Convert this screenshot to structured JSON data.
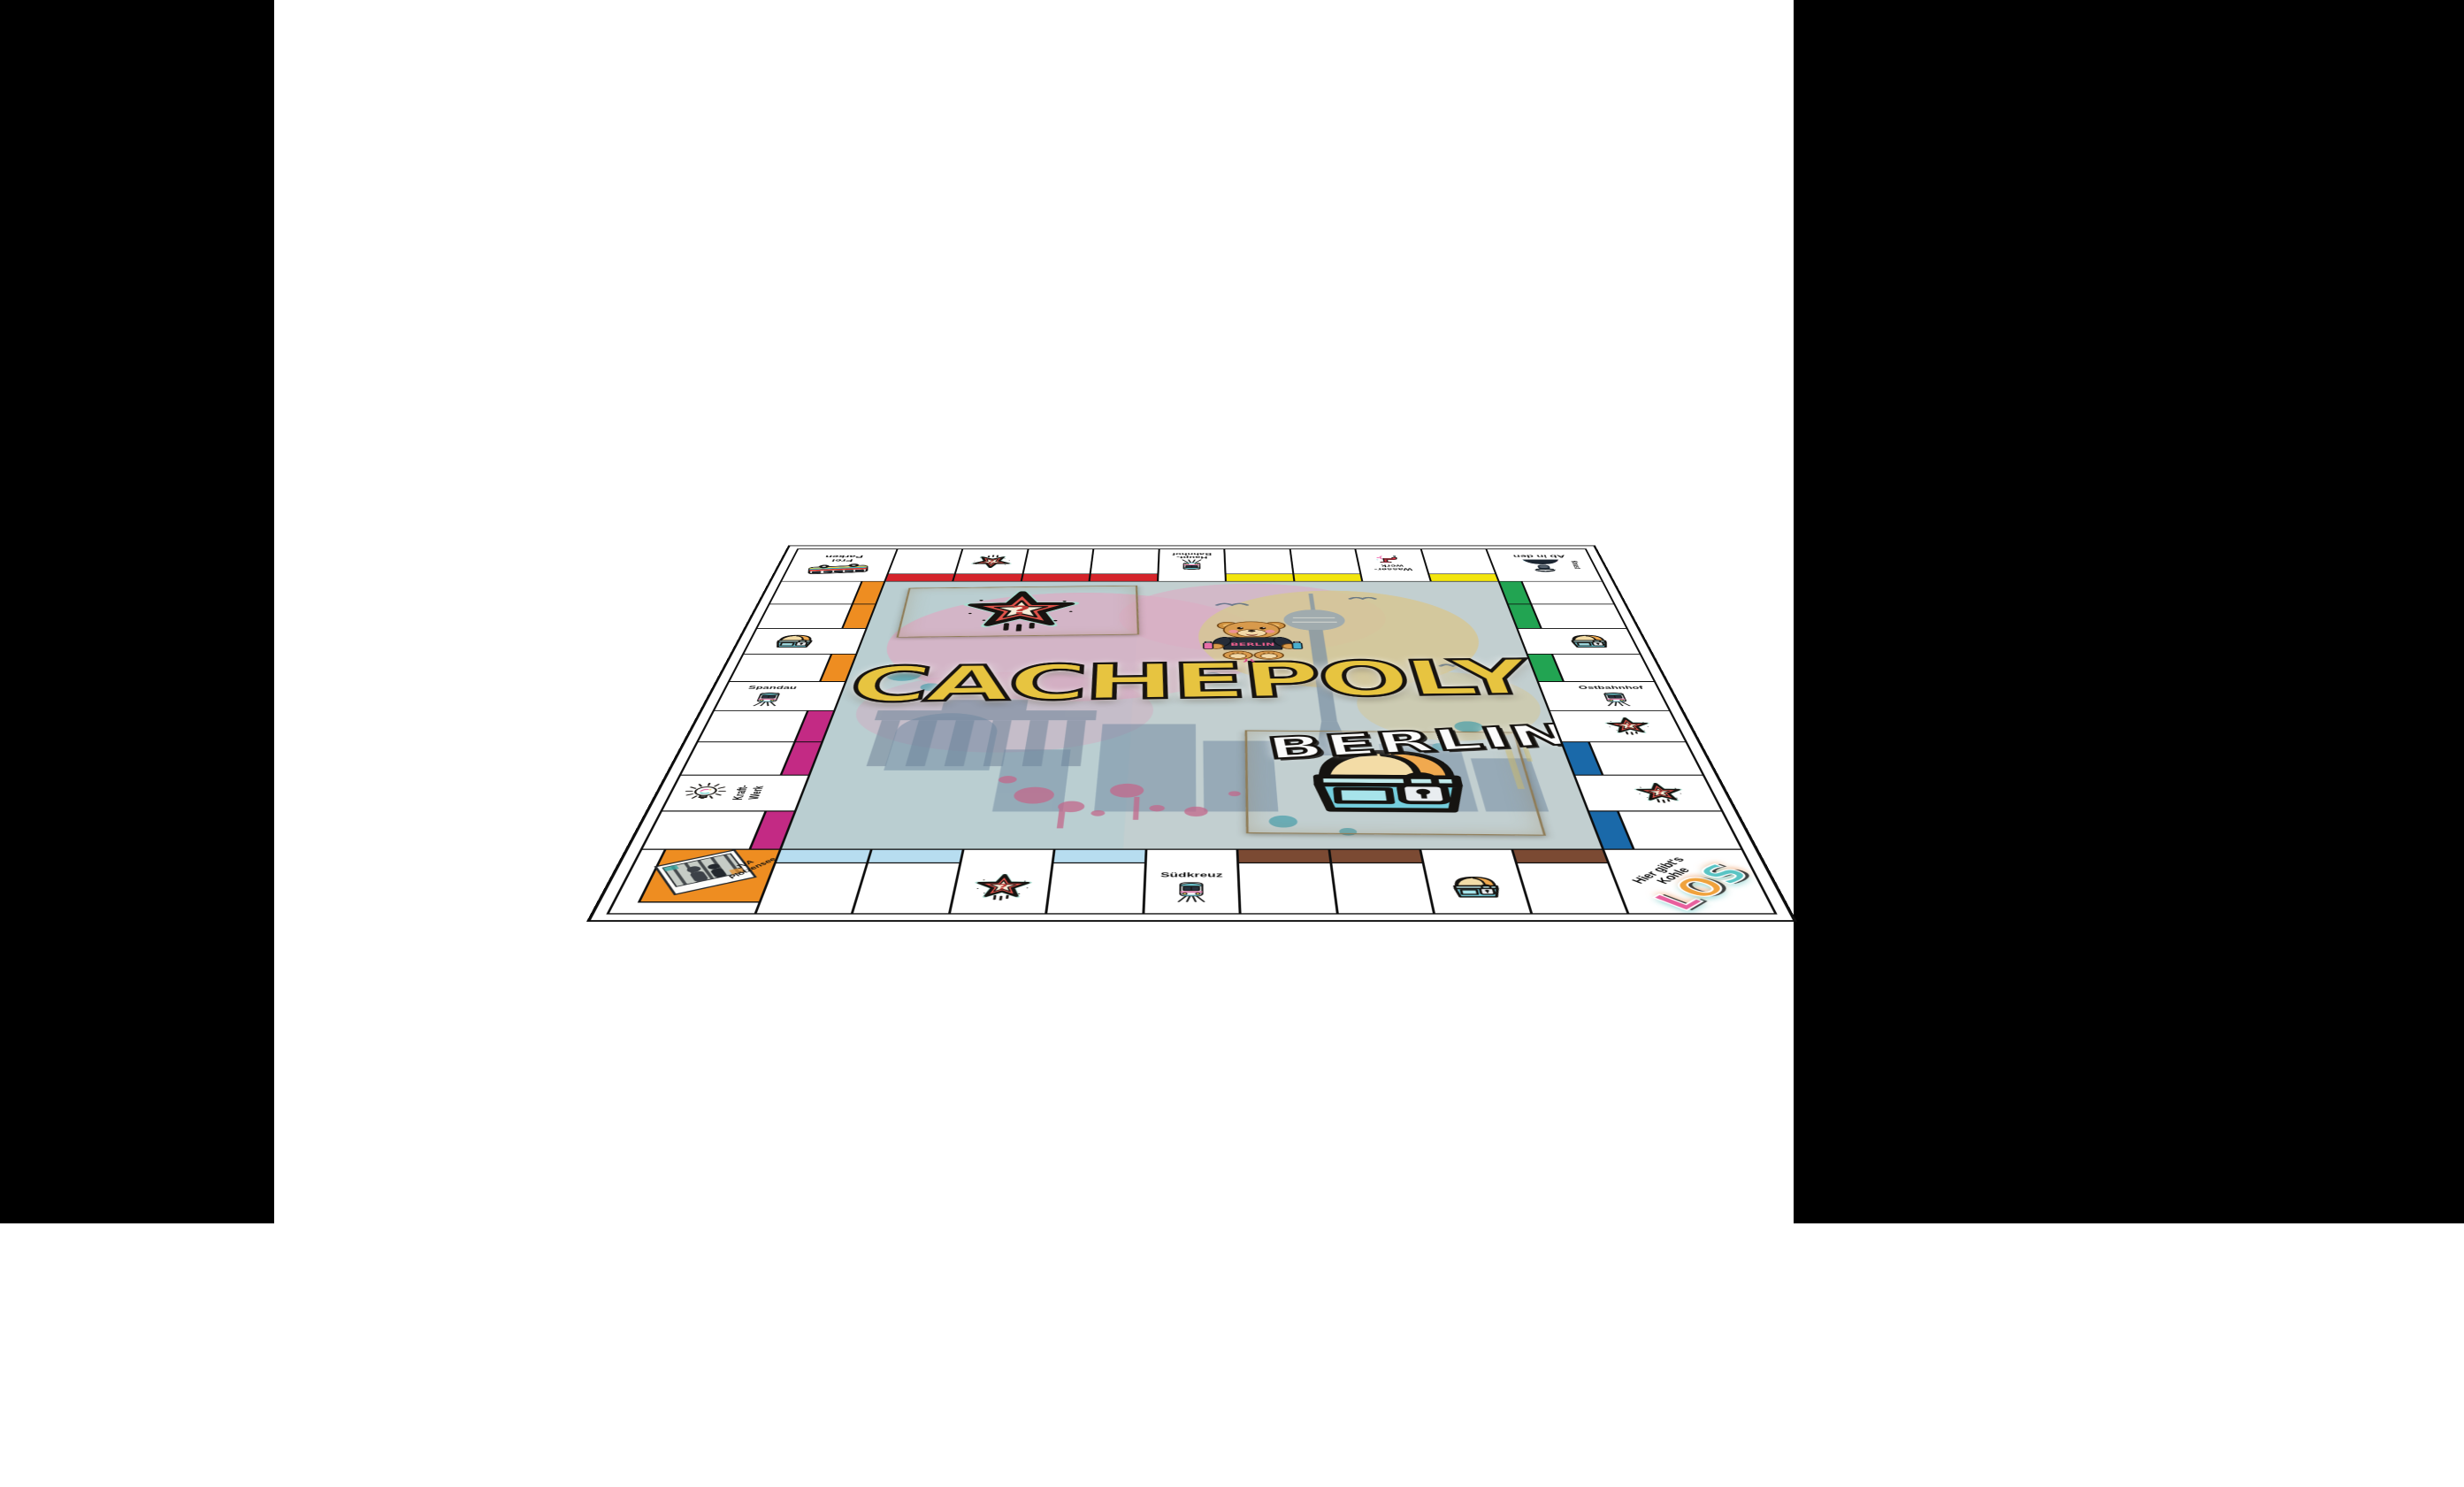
{
  "page": {
    "background": "#ffffff",
    "side_panels": {
      "left_color": "#000000",
      "right_color": "#000000"
    }
  },
  "board": {
    "center": {
      "title": "CACHEPOLY",
      "subtitle": "BERLIN",
      "bear_shirt": "BERLIN"
    },
    "corners": {
      "frei_parken": {
        "line1": "Frei",
        "line2": "Parken"
      },
      "knast": {
        "line1": "Ab in den",
        "line2": "Knast"
      },
      "jva": {
        "line1": "JVA",
        "line2": "Plötzensee"
      },
      "los": {
        "line1": "Hier gibt's",
        "line2": "Kohle",
        "word": "LOS",
        "letter_colors": [
          "#e85f9d",
          "#f0a23c",
          "#59c4c4"
        ]
      }
    },
    "colors": {
      "red": "#d5242b",
      "yellow": "#f3e50d",
      "orange": "#ee8d21",
      "magenta": "#c32a84",
      "green": "#22a452",
      "blue": "#1a69a9",
      "lightblue": "#b7ddf0",
      "brown": "#7b4a33",
      "line": "#0d0d0d",
      "board_bg": "#ffffff",
      "center_bg": "#c2cfd0",
      "card_bg": "#f0e8d4",
      "logo_yellow": "#e7c440",
      "logo_white": "#fafafa",
      "jva_orange": "#ee8d21"
    },
    "track": {
      "top": [
        {
          "kind": "corner",
          "id": "frei_parken"
        },
        {
          "kind": "plot",
          "bar": "red"
        },
        {
          "kind": "chance",
          "bar": "red"
        },
        {
          "kind": "plot",
          "bar": "red"
        },
        {
          "kind": "plot",
          "bar": "red"
        },
        {
          "kind": "station",
          "label": [
            "Haupt-",
            "Bahnhof"
          ]
        },
        {
          "kind": "plot",
          "bar": "yellow"
        },
        {
          "kind": "plot",
          "bar": "yellow"
        },
        {
          "kind": "utility",
          "id": "wasserwerk",
          "label": [
            "Wasser-",
            "werk"
          ]
        },
        {
          "kind": "plot",
          "bar": "yellow"
        },
        {
          "kind": "corner",
          "id": "knast"
        }
      ],
      "left": [
        {
          "kind": "plot",
          "bar": "orange"
        },
        {
          "kind": "plot",
          "bar": "orange"
        },
        {
          "kind": "chest"
        },
        {
          "kind": "plot",
          "bar": "orange"
        },
        {
          "kind": "station",
          "label": [
            "Spandau"
          ]
        },
        {
          "kind": "plot",
          "bar": "magenta"
        },
        {
          "kind": "plot",
          "bar": "magenta"
        },
        {
          "kind": "utility",
          "id": "kraftwerk",
          "label": [
            "Kraft-",
            "Werk"
          ]
        },
        {
          "kind": "plot",
          "bar": "magenta"
        }
      ],
      "right": [
        {
          "kind": "plot",
          "bar": "green"
        },
        {
          "kind": "plot",
          "bar": "green"
        },
        {
          "kind": "chest"
        },
        {
          "kind": "plot",
          "bar": "green"
        },
        {
          "kind": "station",
          "label": [
            "Ostbahnhof"
          ]
        },
        {
          "kind": "chance"
        },
        {
          "kind": "plot",
          "bar": "blue"
        },
        {
          "kind": "chance"
        },
        {
          "kind": "plot",
          "bar": "blue"
        }
      ],
      "bottom": [
        {
          "kind": "corner",
          "id": "jva"
        },
        {
          "kind": "plot",
          "bar": "lightblue"
        },
        {
          "kind": "plot",
          "bar": "lightblue"
        },
        {
          "kind": "chance"
        },
        {
          "kind": "plot",
          "bar": "lightblue"
        },
        {
          "kind": "station",
          "label": [
            "Südkreuz"
          ]
        },
        {
          "kind": "plot",
          "bar": "brown"
        },
        {
          "kind": "plot",
          "bar": "brown"
        },
        {
          "kind": "chest"
        },
        {
          "kind": "plot",
          "bar": "brown"
        },
        {
          "kind": "corner",
          "id": "los"
        }
      ]
    }
  }
}
